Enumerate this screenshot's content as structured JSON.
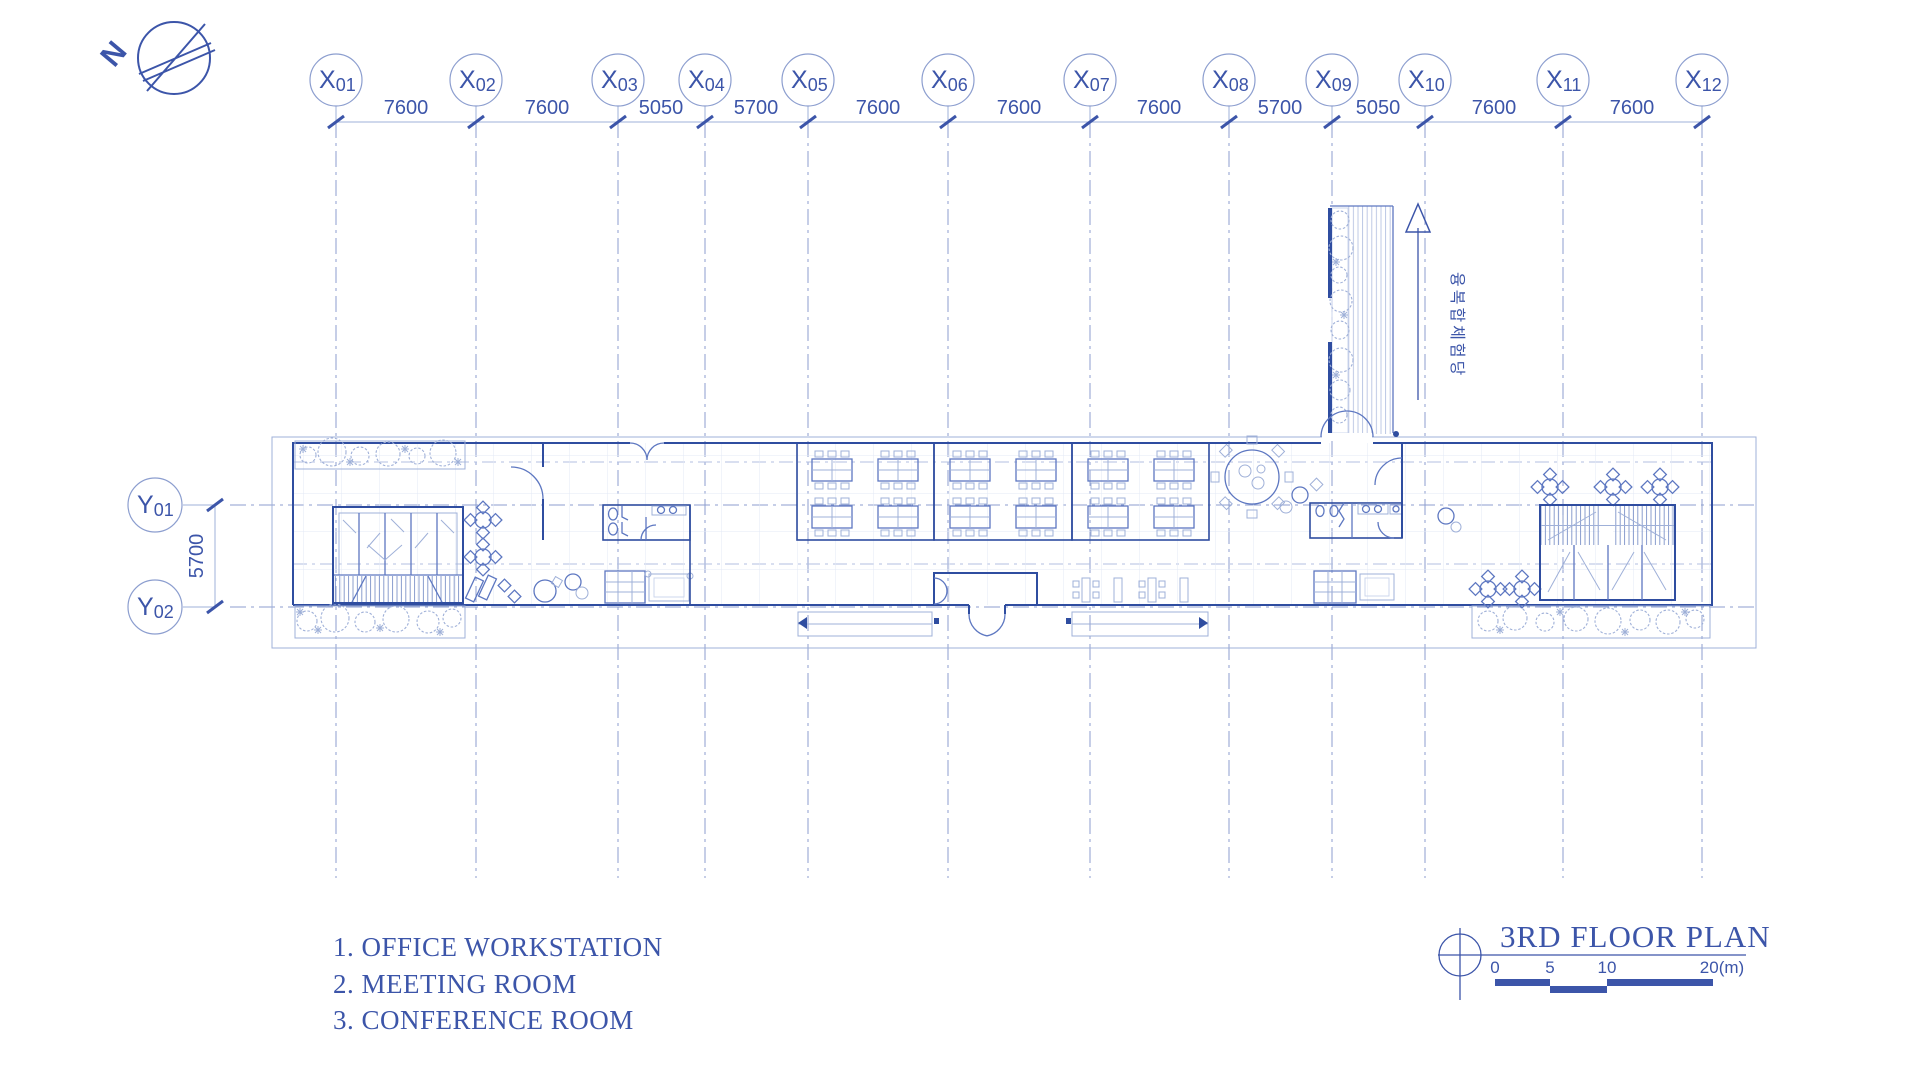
{
  "compass": {
    "label": "N"
  },
  "grid": {
    "x_bubbles": [
      {
        "p": "X",
        "n": "01"
      },
      {
        "p": "X",
        "n": "02"
      },
      {
        "p": "X",
        "n": "03"
      },
      {
        "p": "X",
        "n": "04"
      },
      {
        "p": "X",
        "n": "05"
      },
      {
        "p": "X",
        "n": "06"
      },
      {
        "p": "X",
        "n": "07"
      },
      {
        "p": "X",
        "n": "08"
      },
      {
        "p": "X",
        "n": "09"
      },
      {
        "p": "X",
        "n": "10"
      },
      {
        "p": "X",
        "n": "11"
      },
      {
        "p": "X",
        "n": "12"
      }
    ],
    "x_dims": [
      "7600",
      "7600",
      "5050",
      "5700",
      "7600",
      "7600",
      "7600",
      "5700",
      "5050",
      "7600",
      "7600"
    ],
    "y_bubbles": [
      {
        "p": "Y",
        "n": "01"
      },
      {
        "p": "Y",
        "n": "02"
      }
    ],
    "y_dim": "5700"
  },
  "plan": {
    "bridge_annotation": "융복합체험당"
  },
  "legend": {
    "items": [
      "1. OFFICE WORKSTATION",
      "2. MEETING ROOM",
      "3. CONFERENCE ROOM"
    ]
  },
  "title_block": {
    "title": "3RD FLOOR PLAN",
    "scale_ticks": [
      "0",
      "5",
      "10",
      "20(m)"
    ]
  },
  "colors": {
    "ink": "#3c55a9",
    "wall": "#2f4da0",
    "medium": "#5d77c1",
    "light": "#9fb0d8"
  }
}
